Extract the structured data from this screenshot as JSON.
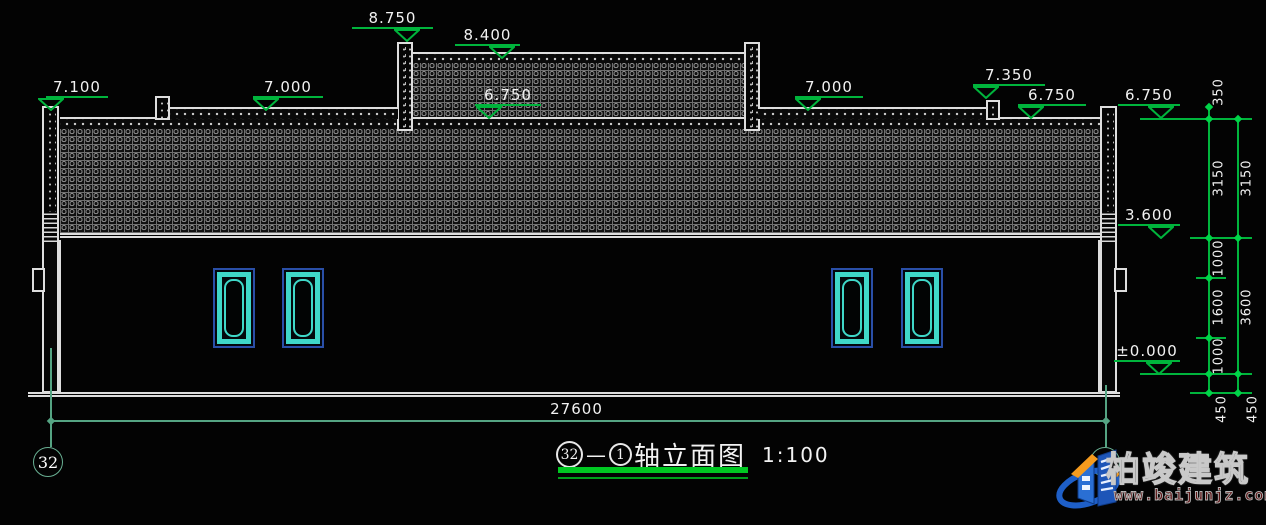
{
  "colors": {
    "line_white": "#dedede",
    "marker_green": "#00b43c",
    "axis_teal": "#55a483",
    "title_green": "#00c822",
    "window_cyan": "#3fd8c8",
    "window_blue": "#2a4fa8",
    "logo_blue": "#1e5fc8",
    "logo_orange": "#f59b1e"
  },
  "elevations": [
    "8.750",
    "8.400",
    "7.100",
    "7.000",
    "6.750",
    "7.000",
    "7.350",
    "6.750",
    "6.750",
    "3.600",
    "±0.000"
  ],
  "dims": {
    "bottom": "27600",
    "right_inner": [
      "350",
      "3150",
      "1000",
      "1600",
      "1000",
      "450"
    ],
    "right_outer": [
      "3150",
      "3600",
      "450"
    ]
  },
  "axes": {
    "left": "32",
    "right": "1"
  },
  "title": {
    "axis_start": "32",
    "separator": "—",
    "axis_end": "1",
    "name": "轴立面图",
    "scale": "1:100"
  },
  "logo": {
    "company": "柏竣建筑",
    "website": "www.baijunjz.com"
  }
}
